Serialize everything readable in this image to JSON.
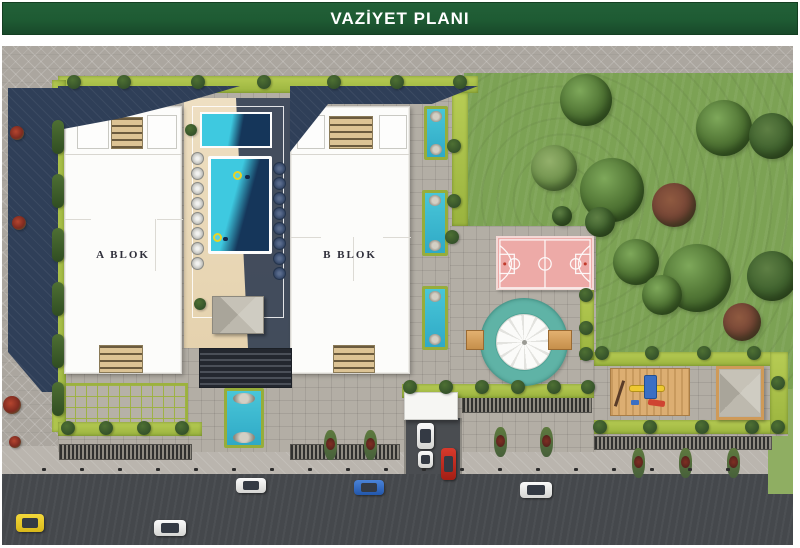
{
  "header": {
    "title": "VAZİYET PLANI"
  },
  "blocks": {
    "a_label": "A BLOK",
    "b_label": "B BLOK"
  },
  "palette": {
    "green": "#1e5b33",
    "road": "#45484c",
    "lawn": "#7ca254",
    "lawn2": "#8fae62",
    "poolA": "#3ec9e0",
    "poolB": "#15365a",
    "court": "#edaaa7",
    "teal": "#5fb3a6",
    "wood": "#dcae72"
  },
  "scene": {
    "trees": [
      {
        "l": 558,
        "t": 28,
        "w": 52,
        "h": 52
      },
      {
        "l": 694,
        "t": 54,
        "w": 56,
        "h": 56
      },
      {
        "l": 747,
        "t": 67,
        "w": 46,
        "h": 46,
        "v": "dark"
      },
      {
        "l": 529,
        "t": 99,
        "w": 46,
        "h": 46,
        "v": "light"
      },
      {
        "l": 578,
        "t": 112,
        "w": 64,
        "h": 64
      },
      {
        "l": 583,
        "t": 161,
        "w": 30,
        "h": 30,
        "v": "dark"
      },
      {
        "l": 611,
        "t": 193,
        "w": 46,
        "h": 46
      },
      {
        "l": 661,
        "t": 198,
        "w": 68,
        "h": 68
      },
      {
        "l": 745,
        "t": 205,
        "w": 50,
        "h": 50,
        "v": "dark"
      },
      {
        "l": 640,
        "t": 229,
        "w": 40,
        "h": 40
      },
      {
        "l": 550,
        "t": 160,
        "w": 20,
        "h": 20,
        "v": "dark"
      },
      {
        "l": 650,
        "t": 137,
        "w": 44,
        "h": 44,
        "v": "red",
        "n": "autumn-tree"
      },
      {
        "l": 721,
        "t": 257,
        "w": 38,
        "h": 38,
        "v": "red",
        "n": "autumn-tree"
      }
    ],
    "bushes": [
      {
        "l": 65,
        "t": 29
      },
      {
        "l": 115,
        "t": 29
      },
      {
        "l": 189,
        "t": 29
      },
      {
        "l": 255,
        "t": 29
      },
      {
        "l": 325,
        "t": 29
      },
      {
        "l": 388,
        "t": 29
      },
      {
        "l": 451,
        "t": 29
      },
      {
        "l": 445,
        "t": 93
      },
      {
        "l": 445,
        "t": 148
      },
      {
        "l": 443,
        "t": 184
      },
      {
        "l": 577,
        "t": 242
      },
      {
        "l": 577,
        "t": 275
      },
      {
        "l": 577,
        "t": 301
      },
      {
        "l": 593,
        "t": 300
      },
      {
        "l": 643,
        "t": 300
      },
      {
        "l": 695,
        "t": 300
      },
      {
        "l": 745,
        "t": 300
      },
      {
        "l": 591,
        "t": 374
      },
      {
        "l": 641,
        "t": 374
      },
      {
        "l": 693,
        "t": 374
      },
      {
        "l": 743,
        "t": 374
      },
      {
        "l": 769,
        "t": 374
      },
      {
        "l": 401,
        "t": 334
      },
      {
        "l": 437,
        "t": 334
      },
      {
        "l": 473,
        "t": 334
      },
      {
        "l": 509,
        "t": 334
      },
      {
        "l": 545,
        "t": 334
      },
      {
        "l": 579,
        "t": 334
      },
      {
        "l": 59,
        "t": 375
      },
      {
        "l": 97,
        "t": 375
      },
      {
        "l": 135,
        "t": 375
      },
      {
        "l": 173,
        "t": 375
      },
      {
        "l": 769,
        "t": 330
      },
      {
        "l": 183,
        "t": 78,
        "w": 12,
        "h": 12,
        "v": "small"
      },
      {
        "l": 192,
        "t": 252,
        "v": "small"
      },
      {
        "l": 50,
        "t": 74,
        "v": "hseg"
      },
      {
        "l": 50,
        "t": 128,
        "v": "hseg"
      },
      {
        "l": 50,
        "t": 182,
        "v": "hseg"
      },
      {
        "l": 50,
        "t": 236,
        "v": "hseg"
      },
      {
        "l": 50,
        "t": 288,
        "v": "hseg"
      },
      {
        "l": 50,
        "t": 336,
        "v": "hseg"
      },
      {
        "l": 8,
        "t": 80,
        "v": "flower",
        "n": "flower-bush"
      },
      {
        "l": 10,
        "t": 170,
        "v": "flower",
        "n": "flower-bush"
      },
      {
        "l": 1,
        "t": 350,
        "w": 18,
        "h": 18,
        "v": "flower",
        "n": "flower-bush"
      },
      {
        "l": 7,
        "t": 390,
        "w": 12,
        "h": 12,
        "v": "flower",
        "n": "flower-bush"
      }
    ],
    "loungers": [
      {
        "l": 189,
        "t": 106
      },
      {
        "l": 189,
        "t": 121
      },
      {
        "l": 189,
        "t": 136
      },
      {
        "l": 189,
        "t": 151
      },
      {
        "l": 189,
        "t": 166
      },
      {
        "l": 189,
        "t": 181
      },
      {
        "l": 189,
        "t": 196
      },
      {
        "l": 189,
        "t": 211
      },
      {
        "l": 271,
        "t": 116,
        "v": "dark"
      },
      {
        "l": 271,
        "t": 131,
        "v": "dark"
      },
      {
        "l": 271,
        "t": 146,
        "v": "dark"
      },
      {
        "l": 271,
        "t": 161,
        "v": "dark"
      },
      {
        "l": 271,
        "t": 176,
        "v": "dark"
      },
      {
        "l": 271,
        "t": 191,
        "v": "dark"
      },
      {
        "l": 271,
        "t": 206,
        "v": "dark"
      },
      {
        "l": 271,
        "t": 221,
        "v": "dark"
      }
    ],
    "channels": [
      {
        "l": 422,
        "t": 60,
        "w": 24,
        "h": 54
      },
      {
        "l": 420,
        "t": 144,
        "w": 26,
        "h": 66
      },
      {
        "l": 420,
        "t": 240,
        "w": 26,
        "h": 64
      },
      {
        "l": 222,
        "t": 342,
        "w": 40,
        "h": 60
      }
    ],
    "grates": [
      {
        "l": 57,
        "t": 398,
        "w": 133,
        "h": 16
      },
      {
        "l": 288,
        "t": 398,
        "w": 110,
        "h": 16
      },
      {
        "l": 460,
        "t": 351,
        "w": 130,
        "h": 16
      },
      {
        "l": 592,
        "t": 390,
        "w": 178,
        "h": 14
      }
    ],
    "planters": [
      {
        "l": 322,
        "t": 384
      },
      {
        "l": 362,
        "t": 384
      },
      {
        "l": 492,
        "t": 381
      },
      {
        "l": 538,
        "t": 381
      },
      {
        "l": 630,
        "t": 402
      },
      {
        "l": 677,
        "t": 402
      },
      {
        "l": 725,
        "t": 402
      }
    ],
    "cars": [
      {
        "l": 14,
        "t": 468,
        "w": 28,
        "h": 18,
        "v": "yellow",
        "n": "yellow-car"
      },
      {
        "l": 152,
        "t": 474,
        "w": 32,
        "h": 16,
        "v": "white",
        "n": "white-car"
      },
      {
        "l": 234,
        "t": 432,
        "w": 30,
        "h": 15,
        "v": "white",
        "n": "white-car"
      },
      {
        "l": 352,
        "t": 434,
        "w": 30,
        "h": 15,
        "v": "blue",
        "n": "blue-car"
      },
      {
        "l": 518,
        "t": 436,
        "w": 32,
        "h": 16,
        "v": "white",
        "n": "white-car"
      },
      {
        "l": 439,
        "t": 402,
        "w": 15,
        "h": 32,
        "v": "red vert",
        "n": "red-car"
      },
      {
        "l": 415,
        "t": 377,
        "w": 17,
        "h": 26,
        "v": "white vert",
        "n": "white-van"
      },
      {
        "l": 416,
        "t": 405,
        "w": 15,
        "h": 17,
        "v": "white vert",
        "n": "white-car"
      }
    ],
    "dots": [
      {
        "l": 40,
        "t": 422
      },
      {
        "l": 78,
        "t": 422
      },
      {
        "l": 116,
        "t": 422
      },
      {
        "l": 154,
        "t": 422
      },
      {
        "l": 192,
        "t": 422
      },
      {
        "l": 230,
        "t": 422
      },
      {
        "l": 268,
        "t": 422
      },
      {
        "l": 306,
        "t": 422
      },
      {
        "l": 344,
        "t": 422
      },
      {
        "l": 382,
        "t": 422
      },
      {
        "l": 420,
        "t": 422
      },
      {
        "l": 458,
        "t": 422
      },
      {
        "l": 496,
        "t": 422
      },
      {
        "l": 534,
        "t": 422
      },
      {
        "l": 572,
        "t": 422
      },
      {
        "l": 610,
        "t": 422
      },
      {
        "l": 648,
        "t": 422
      },
      {
        "l": 686,
        "t": 422
      },
      {
        "l": 724,
        "t": 422
      }
    ]
  }
}
